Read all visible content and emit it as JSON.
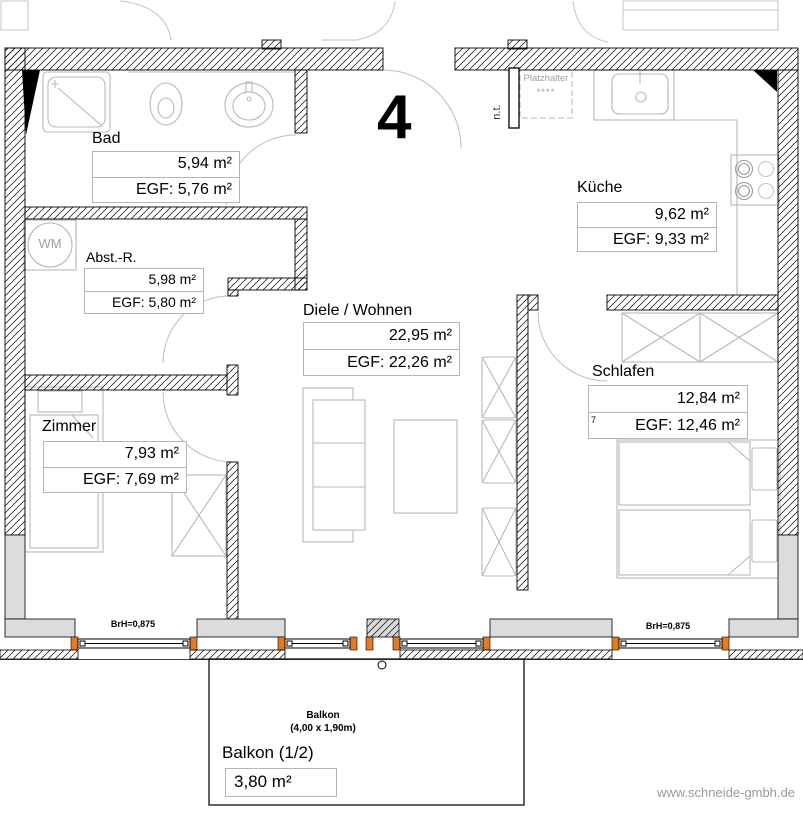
{
  "apartment_number": "4",
  "website": "www.schneide-gmbh.de",
  "rooms": {
    "bad": {
      "name": "Bad",
      "area": "5,94 m²",
      "egf": "EGF: 5,76 m²"
    },
    "kueche": {
      "name": "Küche",
      "area": "9,62 m²",
      "egf": "EGF: 9,33 m²"
    },
    "abstellraum": {
      "name": "Abst.-R.",
      "area": "5,98 m²",
      "egf": "EGF: 5,80 m²"
    },
    "diele": {
      "name": "Diele / Wohnen",
      "area": "22,95 m²",
      "egf": "EGF: 22,26 m²"
    },
    "schlafen": {
      "name": "Schlafen",
      "area": "12,84 m²",
      "egf": "EGF: 12,46 m²",
      "mark": "7"
    },
    "zimmer": {
      "name": "Zimmer",
      "area": "7,93 m²",
      "egf": "EGF: 7,69 m²"
    },
    "balkon": {
      "name": "Balkon (1/2)",
      "area": "3,80 m²",
      "small_name": "Balkon",
      "dimensions": "(4,00 x 1,90m)"
    }
  },
  "annotations": {
    "wm": "WM",
    "placeholder": "Platzhalter",
    "placeholder_stars": "****",
    "nt": "n.t.",
    "sill_height": "BrH=0,875"
  },
  "colors": {
    "window_reveal": "#e87a1e",
    "wall_fill": "#dcdcdc",
    "furniture_line": "#b8b8b8",
    "muted_text": "#9a9a9a"
  }
}
